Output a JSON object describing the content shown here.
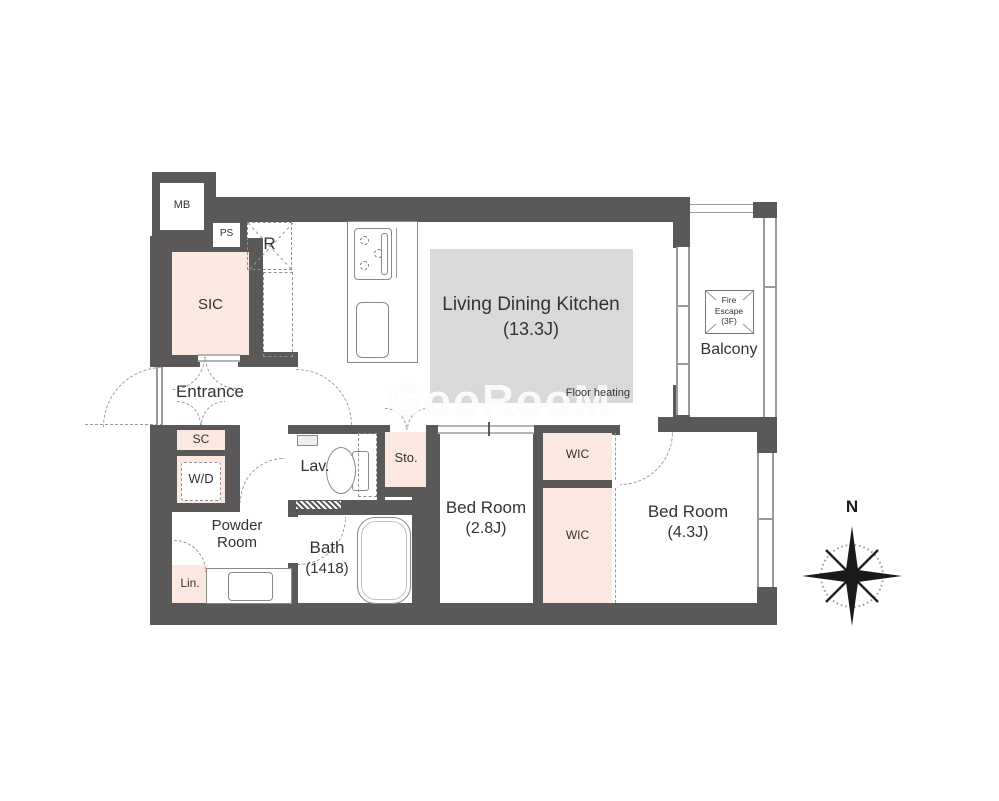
{
  "title": "Apartment floor plan",
  "colors": {
    "wall": "#5a5858",
    "accent_room": "#fbe9e1",
    "floor_heating": "#d9d9d9",
    "door_line": "#9a9a9a"
  },
  "watermark": "GooRooM",
  "compass": {
    "north_label": "N"
  },
  "rooms": {
    "mb": {
      "label": "MB"
    },
    "ps": {
      "label": "PS"
    },
    "refrigerator": {
      "label": "R"
    },
    "sic": {
      "label": "SIC"
    },
    "entrance": {
      "label": "Entrance"
    },
    "sc": {
      "label": "SC"
    },
    "wd": {
      "label": "W/D"
    },
    "ldk": {
      "name": "Living Dining Kitchen",
      "size": "(13.3J)"
    },
    "floor_heating": {
      "label": "Floor heating"
    },
    "balcony": {
      "label": "Balcony"
    },
    "fire_escape": {
      "line1": "Fire",
      "line2": "Escape",
      "line3": "(3F)"
    },
    "lav": {
      "label": "Lav."
    },
    "sto": {
      "label": "Sto."
    },
    "powder_room": {
      "line1": "Powder",
      "line2": "Room"
    },
    "lin": {
      "label": "Lin."
    },
    "bath": {
      "name": "Bath",
      "size": "(1418)"
    },
    "bedroom1": {
      "name": "Bed Room",
      "size": "(2.8J)"
    },
    "wic1": {
      "label": "WIC"
    },
    "wic2": {
      "label": "WIC"
    },
    "bedroom2": {
      "name": "Bed Room",
      "size": "(4.3J)"
    }
  }
}
